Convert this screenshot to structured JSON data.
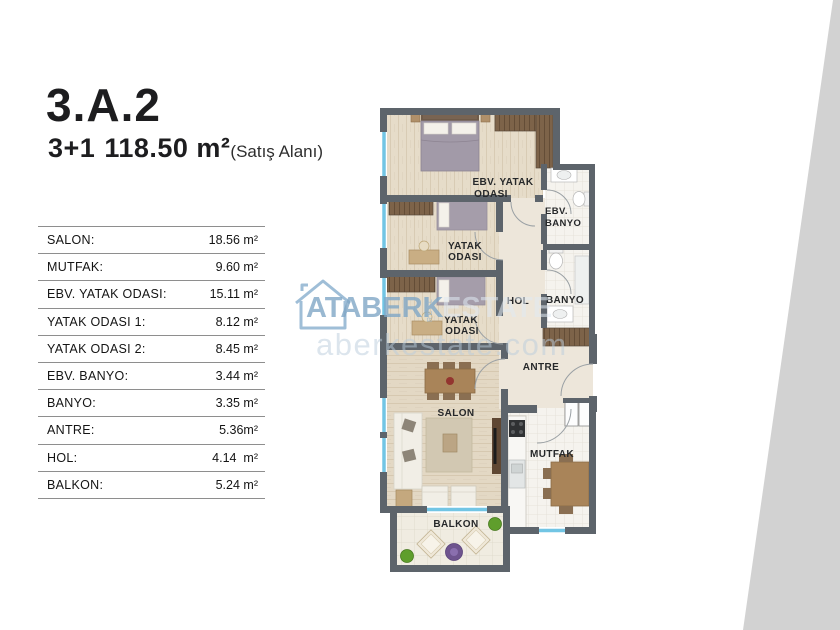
{
  "header": {
    "unit_code": "3.A.2",
    "layout_type": "3+1",
    "total_area": "118.50 m²",
    "area_note": "(Satış Alanı)"
  },
  "area_table": {
    "rows": [
      {
        "label": "SALON:",
        "value": "18.56 m²"
      },
      {
        "label": "MUTFAK:",
        "value": "9.60 m²"
      },
      {
        "label": "EBV. YATAK ODASI:",
        "value": "15.11 m²"
      },
      {
        "label": "YATAK ODASI 1:",
        "value": "8.12 m²"
      },
      {
        "label": "YATAK ODASI 2:",
        "value": "8.45 m²"
      },
      {
        "label": "EBV. BANYO:",
        "value": "3.44 m²"
      },
      {
        "label": "BANYO:",
        "value": "3.35 m²"
      },
      {
        "label": "ANTRE:",
        "value": "5.36m²"
      },
      {
        "label": "HOL:",
        "value": "4.14  m²"
      },
      {
        "label": "BALKON:",
        "value": "5.24 m²"
      }
    ]
  },
  "floor_plan": {
    "labels": {
      "master_bedroom_1": "EBV. YATAK",
      "master_bedroom_2": "ODASI",
      "bedroom1_1": "YATAK",
      "bedroom1_2": "ODASI",
      "bedroom2_1": "YATAK",
      "bedroom2_2": "ODASI",
      "ebv_banyo_1": "EBV.",
      "ebv_banyo_2": "BANYO",
      "hol": "HOL",
      "banyo": "BANYO",
      "antre": "ANTRE",
      "salon": "SALON",
      "mutfak": "MUTFAK",
      "balkon": "BALKON"
    }
  },
  "watermark": {
    "brand": "ATABERK",
    "brand2": "ESTATE",
    "real": "REAL",
    "website": "aberkestate.com"
  },
  "colors": {
    "accent_watermark_blue": "#8fb3d1",
    "wedge_gray": "#d2d2d2",
    "wall_gray": "#5d646b",
    "window_cyan": "#72c5e4",
    "table_line_gray": "#8e8e8e",
    "text_dark": "#1d1d1f"
  }
}
